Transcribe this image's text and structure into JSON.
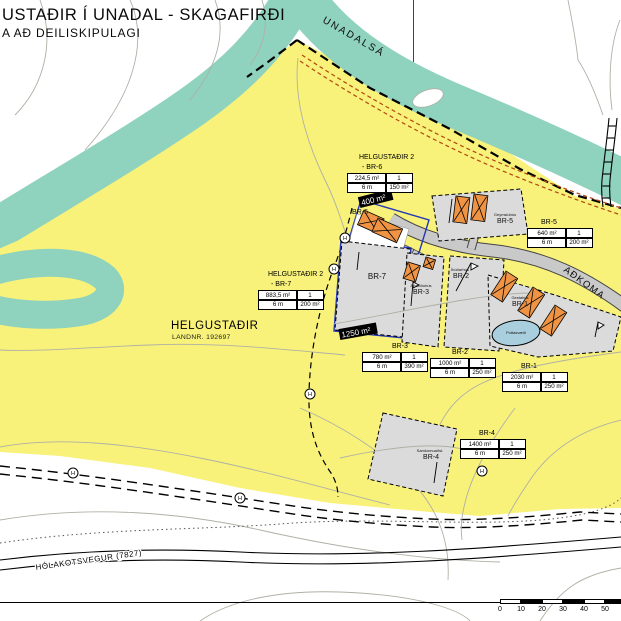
{
  "title": {
    "line1": "USTAÐIR Í UNADAL - SKAGAFIRÐI",
    "line2": "A AÐ DEILISKIPULAGI"
  },
  "labels": {
    "river": "UNADALSÁ",
    "access_road": "AÐKOMA",
    "main_road": "HÓLAKOTSVEGUR (7827)",
    "farm_name": "HELGUSTAÐIR",
    "farm_landnr": "LANDNR. 192697",
    "pond": "Pottasvæði",
    "marker_letter": "H"
  },
  "plots": {
    "br1": {
      "header": "BR-1",
      "name": "BR-1",
      "sublabel": "Gestahús",
      "area": "2030 m²",
      "count": "1",
      "setback": "6 m",
      "building_area": "250 m²"
    },
    "br2": {
      "header": "BR-2",
      "name": "BR-2",
      "sublabel": "Íbúðarhús",
      "area": "1000 m²",
      "count": "1",
      "setback": "6 m",
      "building_area": "250 m²"
    },
    "br3": {
      "header": "BR-3",
      "name": "BR-3",
      "sublabel": "Aðstöðuhús",
      "area": "780 m²",
      "count": "1",
      "setback": "6 m",
      "building_area": "390 m²"
    },
    "br4": {
      "header": "BR-4",
      "name": "BR-4",
      "sublabel": "Samkomuaðst.",
      "area": "1400 m²",
      "count": "1",
      "setback": "6 m",
      "building_area": "250 m²"
    },
    "br5": {
      "header": "BR-5",
      "name": "BR-5",
      "sublabel": "Geymsluhús",
      "area": "640 m²",
      "count": "1",
      "setback": "6 m",
      "building_area": "200 m²"
    },
    "br6": {
      "header1": "HELGUSTAÐIR 2",
      "header2": "- BR-6",
      "name": "BR-6",
      "area": "224,5 m²",
      "count": "1",
      "setback": "6 m",
      "building_area": "150 m²",
      "tag": "400 m²"
    },
    "br7": {
      "header1": "HELGUSTAÐIR 2",
      "header2": "- BR-7",
      "name": "BR-7",
      "area": "883,5 m²",
      "count": "1",
      "setback": "6 m",
      "building_area": "200 m²",
      "tag": "1250 m²"
    }
  },
  "scalebar": {
    "ticks": [
      "0",
      "10",
      "20",
      "30",
      "40",
      "50"
    ]
  },
  "colors": {
    "plan_area": "#F8F27A",
    "river": "#8FD2BD",
    "plot_fill": "#DBDBDB",
    "building": "#EE9444",
    "pond": "#A9CFDF",
    "path_red": "#B3470F",
    "lot_blue": "#2438B8"
  }
}
